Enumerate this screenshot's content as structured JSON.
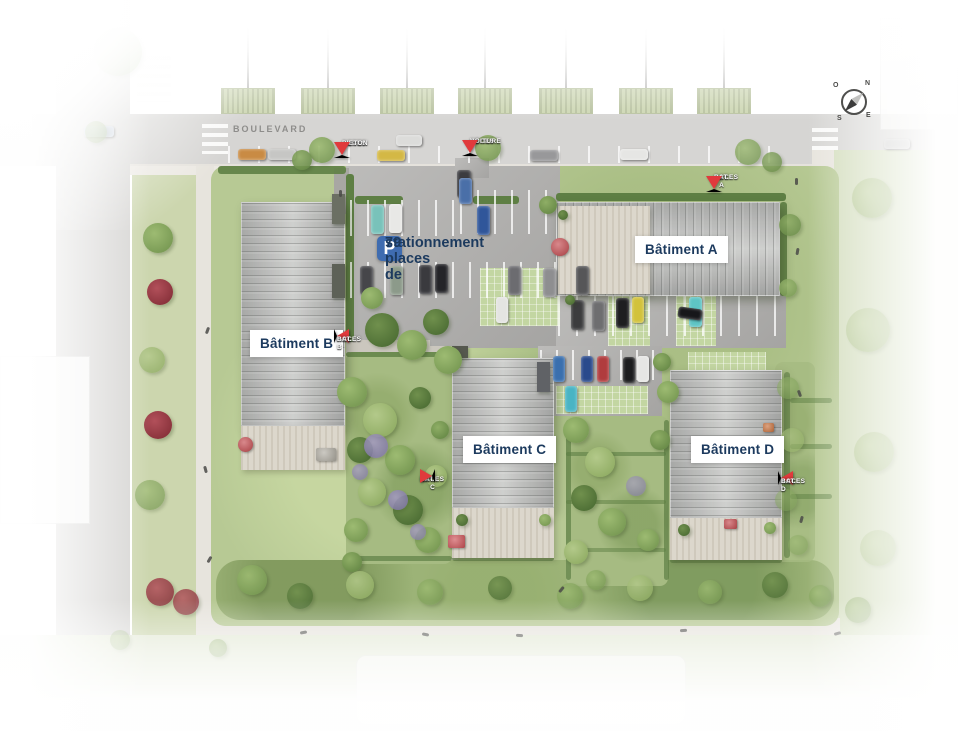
{
  "street": {
    "name": "BOULEVARD"
  },
  "parking": {
    "icon": "P",
    "line1": "79 places de",
    "line2": "stationnement"
  },
  "buildings": {
    "a": "Bâtiment A",
    "b": "Bâtiment B",
    "c": "Bâtiment C",
    "d": "Bâtiment D"
  },
  "access": {
    "pieton": {
      "line1": "ACCES",
      "line2": "PIETON"
    },
    "voiture": {
      "line1": "ACCES",
      "line2": "VOITURE"
    },
    "bat_a": {
      "line1": "ACCES",
      "line2": "BAT. A"
    },
    "bat_b": {
      "line1": "ACCES",
      "line2": "BAT. B"
    },
    "bat_c": {
      "line1": "ACCES",
      "line2": "BAT. C"
    },
    "bat_d": {
      "line1": "ACCES",
      "line2": "BAT. D"
    }
  },
  "compass": {
    "n": "N",
    "s": "S",
    "e": "E",
    "o": "O"
  },
  "colors": {
    "accent_red": "#e03a3c",
    "parking_blue": "#3f6cb0",
    "label_navy": "#1c3a5e"
  }
}
